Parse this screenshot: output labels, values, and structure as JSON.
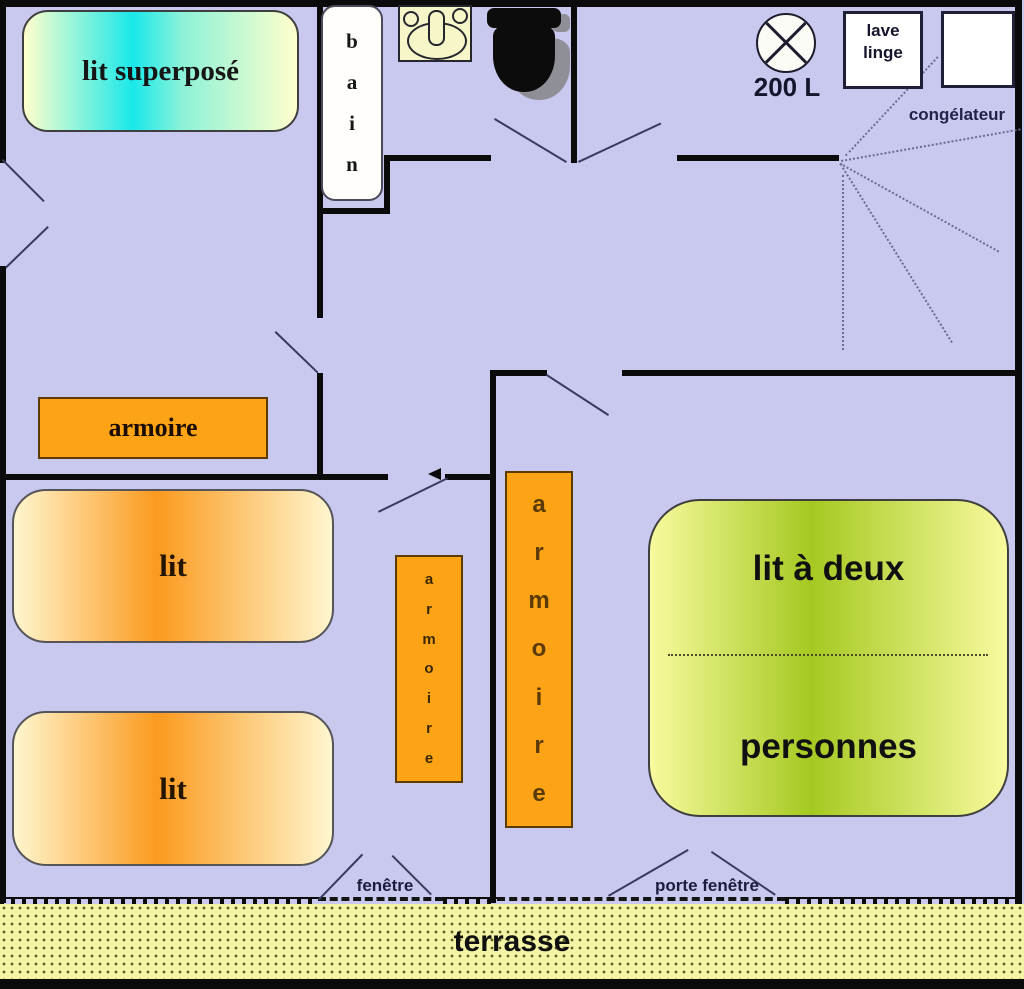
{
  "palette": {
    "background": "#c9c9ef",
    "wall": "#0b0b0b",
    "furniture_orange": "#fca415",
    "bunk_bed_gradient": [
      "#ffffcc",
      "#19e8ea"
    ],
    "single_bed_gradient": [
      "#fff6cf",
      "#fb9a1e"
    ],
    "double_bed_gradient": [
      "#f8fa9e",
      "#a5c921"
    ],
    "terrace_fill": "#f4f4a6",
    "terrace_dot": "#5f5f24",
    "swing_line": "#3a3a5e",
    "label_navy": "#1c1c3c"
  },
  "labels": {
    "bunk_bed": "lit superposé",
    "bath_letters": [
      "b",
      "a",
      "i",
      "n"
    ],
    "water_heater": "200 L",
    "washer_line1": "lave",
    "washer_line2": "linge",
    "freezer": "congélateur",
    "wardrobe": "armoire",
    "wardrobe_letters": [
      "a",
      "r",
      "m",
      "o",
      "i",
      "r",
      "e"
    ],
    "bed": "lit",
    "double_bed_line1": "lit à deux",
    "double_bed_line2": "personnes",
    "window": "fenêtre",
    "french_window": "porte fenêtre",
    "terrace": "terrasse"
  }
}
